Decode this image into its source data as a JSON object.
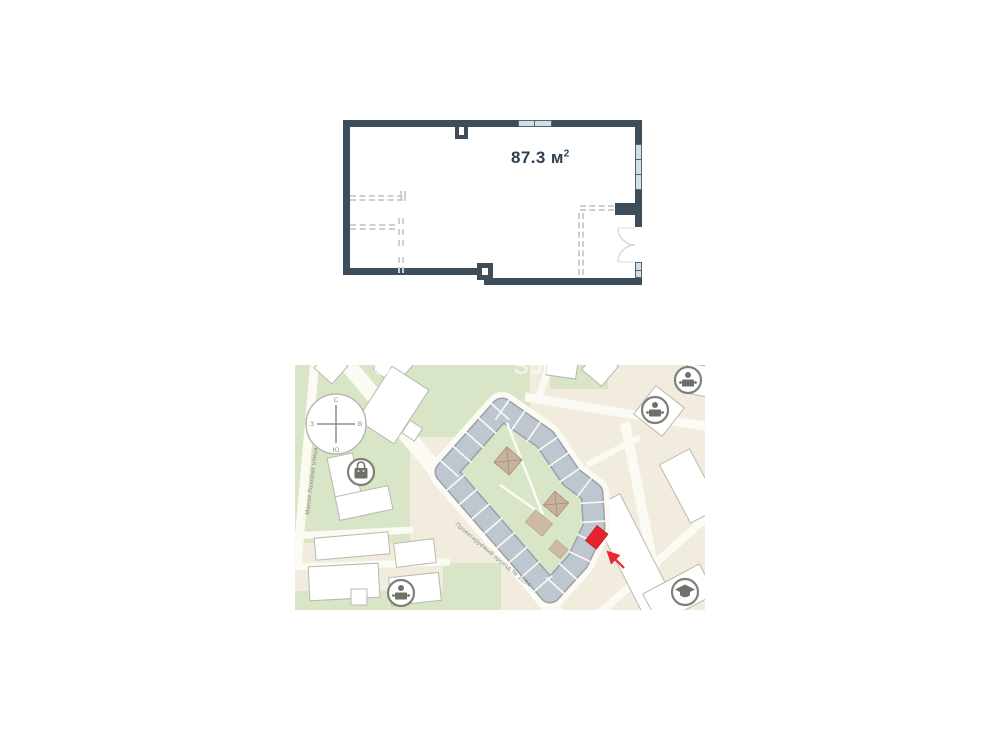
{
  "floor_plan": {
    "area_value": "87.3",
    "area_unit": "м",
    "area_sup": "2"
  },
  "map": {
    "street_vertical": "Малая Лыковая улица",
    "street_diagonal": "Проектируемый проезд № 1094",
    "compass": {
      "n": "С",
      "s": "Ю",
      "w": "З",
      "e": "В"
    },
    "watermark_left": "U",
    "watermark_center": "S5Е",
    "poi": [
      {
        "name": "kindergarten-top-right",
        "icon": "person-desk-icon"
      },
      {
        "name": "kindergarten-right",
        "icon": "person-desk-icon"
      },
      {
        "name": "shop-left",
        "icon": "shopping-bag-icon"
      },
      {
        "name": "kindergarten-bottom",
        "icon": "person-desk-icon"
      },
      {
        "name": "school-bottom-right",
        "icon": "graduation-cap-icon"
      }
    ],
    "colors": {
      "wall": "#3d4d59",
      "window": "#cfe0ea",
      "map_bg": "#f1ecdd",
      "green": "#d9e5c7",
      "building_block": "#bec7d0",
      "marker_red": "#e8232e"
    }
  }
}
